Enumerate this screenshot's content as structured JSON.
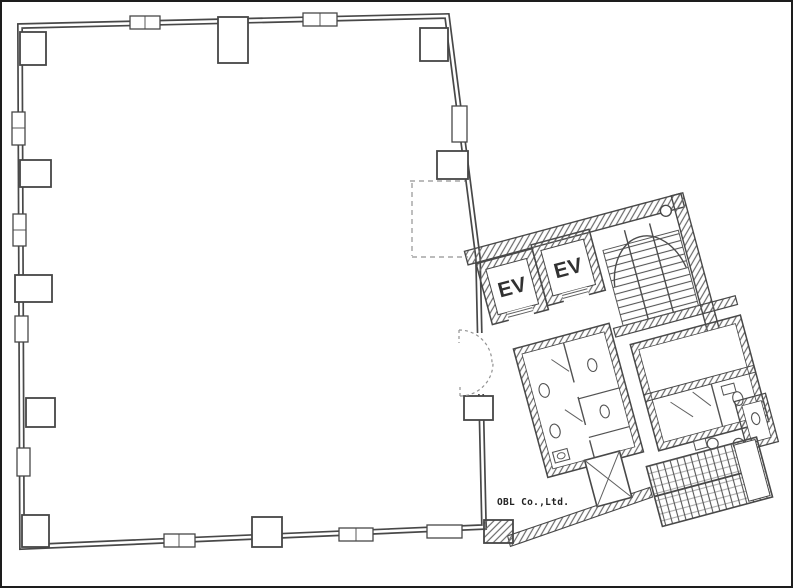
{
  "plan": {
    "labels": {
      "elevator_1": "EV",
      "elevator_2": "EV"
    },
    "watermark": "OBL Co.,Ltd.",
    "colors": {
      "background": "#ffffff",
      "ink": "#3a3a3a",
      "hatch": "#5f5f5f",
      "light_ink": "#8a8a8a",
      "label_ink": "#222222",
      "frame": "#1d1d1d"
    }
  }
}
